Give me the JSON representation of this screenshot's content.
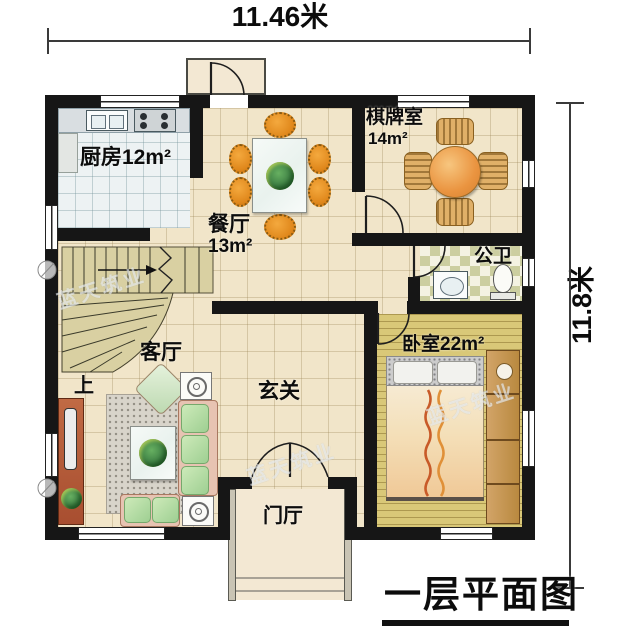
{
  "title": "一层平面图",
  "dimensions": {
    "width": "11.46米",
    "height": "11.8米"
  },
  "rooms": {
    "kitchen": {
      "label": "厨房12m²"
    },
    "dining": {
      "name": "餐厅",
      "area": "13m²"
    },
    "chess": {
      "name": "棋牌室",
      "area": "14m²"
    },
    "bath": {
      "name": "公卫"
    },
    "bedroom": {
      "label": "卧室22m²"
    },
    "living": {
      "name": "客厅"
    },
    "hall": {
      "name": "玄关"
    },
    "foyer": {
      "name": "门厅"
    }
  },
  "stairs": {
    "direction_label": "上"
  },
  "watermark": {
    "text": "蓝天筑业"
  },
  "palette": {
    "wall": "#161616",
    "tile_floor": "#f1e5c9",
    "kitchen_floor": "#edf2f3",
    "wood_floor": "#d9c878",
    "checker_floor": "#cccea0",
    "stair": "#d9d0a2",
    "chair_orange": "#e0881c",
    "sofa_green": "#aed7a0",
    "cabinet_red": "#b85c3c"
  }
}
